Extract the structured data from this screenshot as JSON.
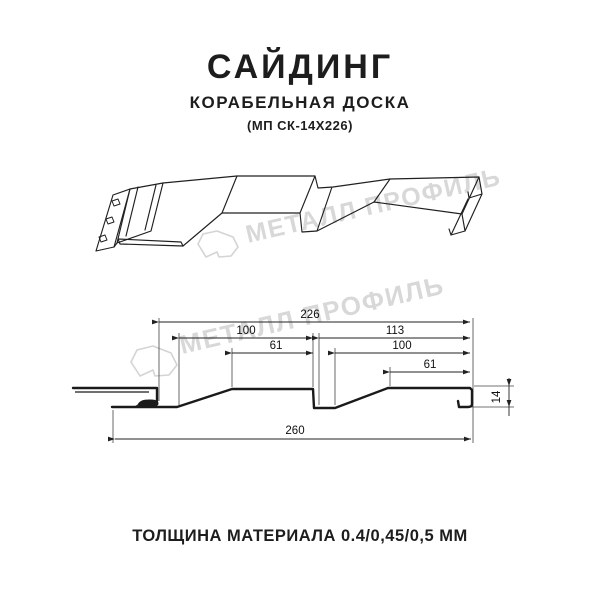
{
  "header": {
    "title": "САЙДИНГ",
    "subtitle": "КОРАБЕЛЬНАЯ ДОСКА",
    "code": "(МП СК-14Х226)"
  },
  "watermark": {
    "text": "МЕТАЛЛ ПРОФИЛЬ"
  },
  "dimensions": {
    "overall_module": "226",
    "left_pitch": "100",
    "left_flat": "61",
    "right_module": "113",
    "right_pitch": "100",
    "right_flat": "61",
    "total_width": "260",
    "height": "14"
  },
  "footer": {
    "thickness_label": "ТОЛЩИНА МАТЕРИАЛА 0.4/0,45/0,5 ММ"
  },
  "colors": {
    "line": "#1a1a1a",
    "dimension": "#222222",
    "watermark": "#d8d8d8",
    "background": "#ffffff"
  }
}
